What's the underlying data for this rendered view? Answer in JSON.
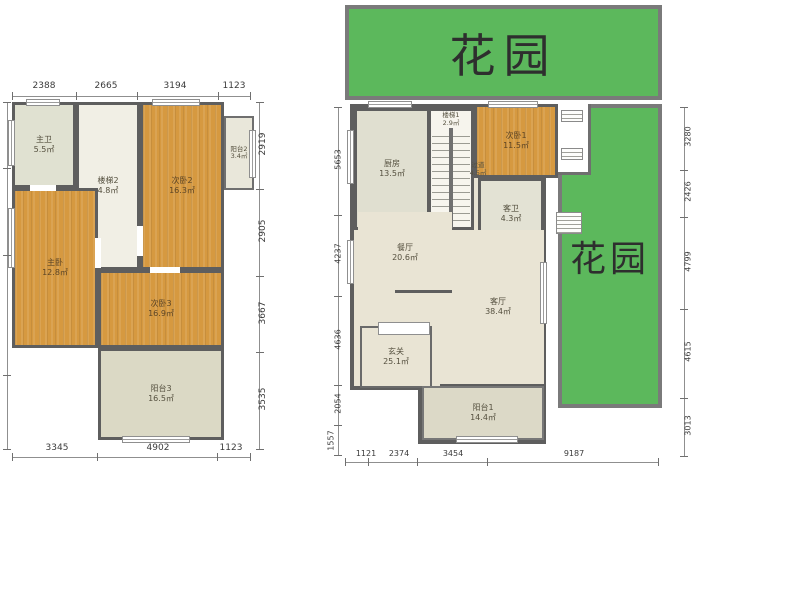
{
  "left_plan": {
    "dims_top": [
      "2388",
      "2665",
      "3194",
      "1123"
    ],
    "dims_right": [
      "2919",
      "2905",
      "3667",
      "3535"
    ],
    "dims_bottom": [
      "3345",
      "4902",
      "1123"
    ],
    "dims_left": [
      "2919",
      "2905",
      "3667",
      "3535"
    ],
    "rooms": [
      {
        "name": "主卫",
        "area": "5.5㎡"
      },
      {
        "name": "楼梯2",
        "area": "4.8㎡"
      },
      {
        "name": "次卧2",
        "area": "16.3㎡"
      },
      {
        "name": "阳台2",
        "area": "3.4㎡"
      },
      {
        "name": "主卧",
        "area": "12.8㎡"
      },
      {
        "name": "次卧3",
        "area": "16.9㎡"
      },
      {
        "name": "阳台3",
        "area": "16.5㎡"
      }
    ]
  },
  "right_plan": {
    "garden_top_label": "花园",
    "garden_right_label": "花园",
    "dims_bottom": [
      "1121",
      "2374",
      "3454",
      "9187"
    ],
    "dims_left": [
      "5653",
      "4237",
      "4636",
      "2054",
      "1557"
    ],
    "dims_right": [
      "3280",
      "2426",
      "4799",
      "4615",
      "3013"
    ],
    "rooms": [
      {
        "name": "厨房",
        "area": "13.5㎡"
      },
      {
        "name": "楼梯1",
        "area": "2.9㎡"
      },
      {
        "name": "次卧1",
        "area": "11.5㎡"
      },
      {
        "name": "客卫",
        "area": "4.3㎡"
      },
      {
        "name": "过道",
        "area": "4.5㎡"
      },
      {
        "name": "餐厅",
        "area": "20.6㎡"
      },
      {
        "name": "客厅",
        "area": "38.4㎡"
      },
      {
        "name": "玄关",
        "area": "25.1㎡"
      },
      {
        "name": "阳台1",
        "area": "14.4㎡"
      }
    ]
  },
  "colors": {
    "garden_green": "#5cb85c",
    "wall_gray": "#5e5e5e",
    "wood_orange": "#d69940",
    "tile_beige": "#e0e1d1"
  }
}
